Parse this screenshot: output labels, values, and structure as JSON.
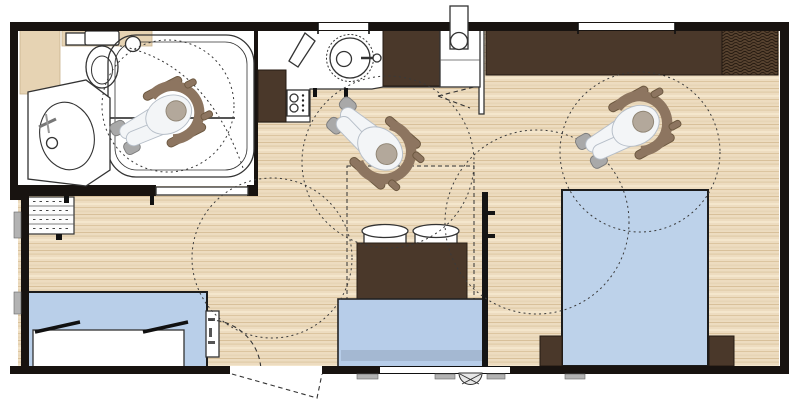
{
  "meta": {
    "title": "Accessible mobile-home floor plan (top view)",
    "canvas": {
      "width": 800,
      "height": 411
    }
  },
  "colors": {
    "wall": "#181310",
    "floor_wood": "#eddcc0",
    "wood_stripe_dark": "#dcc5a0",
    "wood_stripe_light": "#f4e6cc",
    "room_white": "#ffffff",
    "furniture_dark": "#4a382a",
    "wardrobe_hatch": "#57422f",
    "bed_blue": "#bdd2ea",
    "sofa_blue": "#b7cde9",
    "sofa_seat": "#a4b8d2",
    "kidsroom_blue": "#b9cfe9",
    "fixture_gray": "#b3b3b3",
    "wheelchair_brown": "#8d7560",
    "body_white": "#f3f5f7",
    "head_tan": "#b3a89b",
    "dash_line": "#3a3a3a",
    "shelf_wood": "#e6d3b3"
  },
  "floorplan": {
    "type": "wheelchair-accessible layout",
    "rooms": [
      {
        "id": "bathroom",
        "features": [
          "roll-in-shower",
          "toilet",
          "washbasin",
          "grab-bar",
          "sliding-door",
          "wheelchair-user",
          "turning-circle"
        ]
      },
      {
        "id": "kitchen",
        "features": [
          "round-sink",
          "cooktop-2-burners",
          "counter",
          "tall-unit",
          "water-heater-closet"
        ]
      },
      {
        "id": "living-room",
        "features": [
          "sofa",
          "table",
          "two-chairs",
          "entry-door",
          "shelf-unit",
          "turning-circles",
          "dashed-option-zone"
        ]
      },
      {
        "id": "master-bedroom",
        "features": [
          "double-bed",
          "two-nightstands",
          "wardrobe",
          "hanging-space",
          "sliding-door",
          "wheelchair-user",
          "turning-circle"
        ]
      },
      {
        "id": "kids-bedroom",
        "features": [
          "twin-beds",
          "tall-cabinet",
          "door-swing"
        ]
      }
    ],
    "counts": {
      "wheelchair_users": 3,
      "turning_circles": 5,
      "windows": 5,
      "doors": 4
    }
  }
}
